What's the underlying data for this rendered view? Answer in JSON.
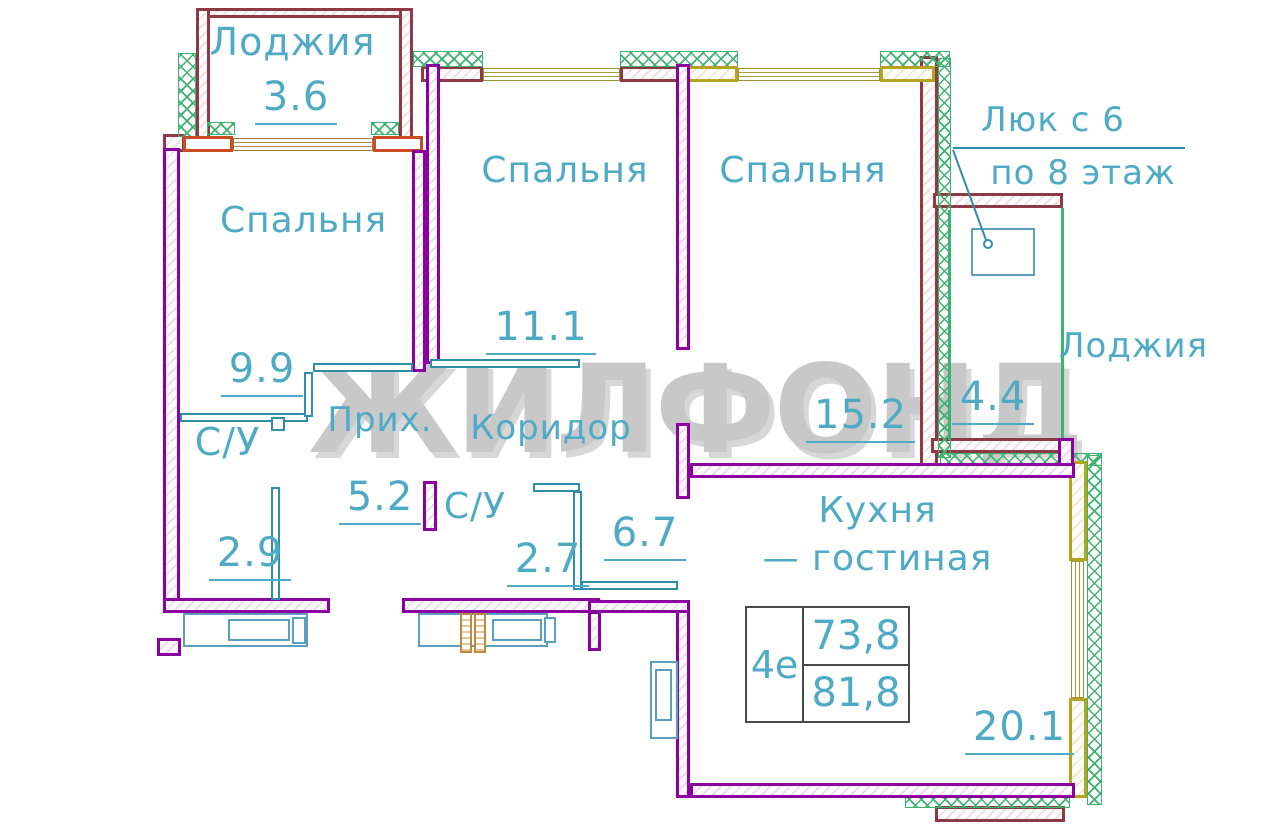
{
  "watermark": "ЖИЛФОНД",
  "hatch_note": {
    "line1": "Люк с 6",
    "line2": "по 8 этаж"
  },
  "info_box": {
    "type_label": "4е",
    "area_living": "73,8",
    "area_total": "81,8"
  },
  "rooms": {
    "loggia_top": {
      "name": "Лоджия",
      "area": "3.6"
    },
    "bedroom_left": {
      "name": "Спальня",
      "area": "9.9"
    },
    "bedroom_mid": {
      "name": "Спальня",
      "area": "11.1"
    },
    "bedroom_right": {
      "name": "Спальня",
      "area": "15.2"
    },
    "bath_left": {
      "name": "С/У",
      "area": "2.9"
    },
    "hall": {
      "name": "Прих.",
      "area": "5.2"
    },
    "corridor": {
      "name": "Коридор",
      "area": "6.7"
    },
    "bath_mid": {
      "name": "С/У",
      "area": "2.7"
    },
    "kitchen": {
      "name_line1": "Кухня",
      "name_line2": "— гостиная",
      "area": "20.1"
    },
    "loggia_right": {
      "name": "Лоджия",
      "area": "4.4"
    }
  },
  "colors": {
    "wall_interior": "#8C00A2",
    "wall_exterior": "#8E3A46",
    "insulation": "#3CB371",
    "window_frame_yellow": "#B5A41F",
    "window_frame_orange": "#CD4B22",
    "text": "#4FAAC6",
    "partition": "#2E8FA8",
    "watermark": "#C8C8C8"
  }
}
